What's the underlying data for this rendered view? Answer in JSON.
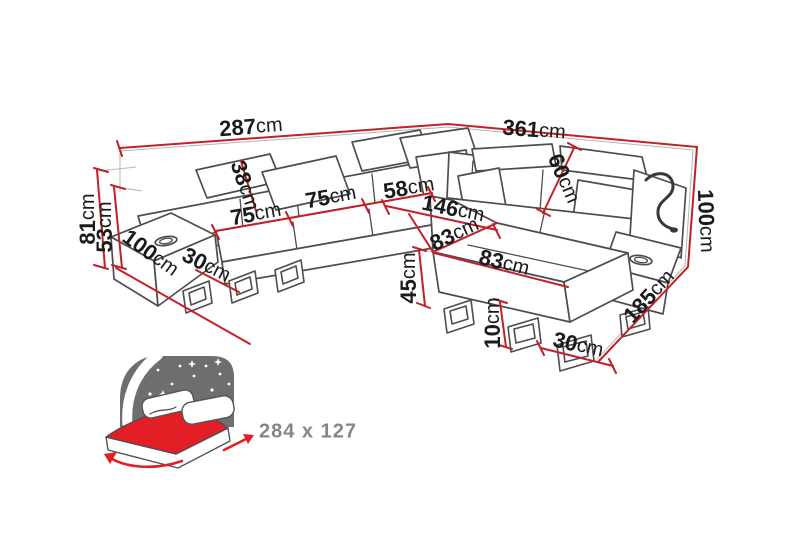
{
  "figure": {
    "description": "Corner sofa-bed technical dimension diagram",
    "unit": "cm"
  },
  "dimensions": [
    {
      "id": "top-left-width",
      "value": "287",
      "unit": "cm"
    },
    {
      "id": "top-right-width",
      "value": "361",
      "unit": "cm"
    },
    {
      "id": "total-height",
      "value": "81",
      "unit": "cm"
    },
    {
      "id": "armrest-height",
      "value": "53",
      "unit": "cm"
    },
    {
      "id": "left-arm-depth",
      "value": "100",
      "unit": "cm"
    },
    {
      "id": "left-arm-width",
      "value": "30",
      "unit": "cm"
    },
    {
      "id": "headrest-height",
      "value": "38",
      "unit": "cm"
    },
    {
      "id": "seat-width-first",
      "value": "75",
      "unit": "cm"
    },
    {
      "id": "seat-width-second",
      "value": "75",
      "unit": "cm"
    },
    {
      "id": "corner-seat-width",
      "value": "58",
      "unit": "cm"
    },
    {
      "id": "chaise-length",
      "value": "146",
      "unit": "cm"
    },
    {
      "id": "backrest-height",
      "value": "60",
      "unit": "cm"
    },
    {
      "id": "corner-depth",
      "value": "83",
      "unit": "cm"
    },
    {
      "id": "chaise-width",
      "value": "83",
      "unit": "cm"
    },
    {
      "id": "seat-height",
      "value": "45",
      "unit": "cm"
    },
    {
      "id": "leg-height",
      "value": "10",
      "unit": "cm"
    },
    {
      "id": "right-arm-width",
      "value": "30",
      "unit": "cm"
    },
    {
      "id": "right-side-depth",
      "value": "185",
      "unit": "cm"
    },
    {
      "id": "right-side-height",
      "value": "100",
      "unit": "cm"
    }
  ],
  "sleeping_area": {
    "label": "284 x 127"
  },
  "colors": {
    "dimension_red": "#c32027",
    "outline_gray": "#4d4d4d",
    "label_black": "#1b1b1b",
    "muted_gray": "#868686",
    "icon_gray": "#6e6e6e",
    "icon_red": "#e31e24"
  }
}
